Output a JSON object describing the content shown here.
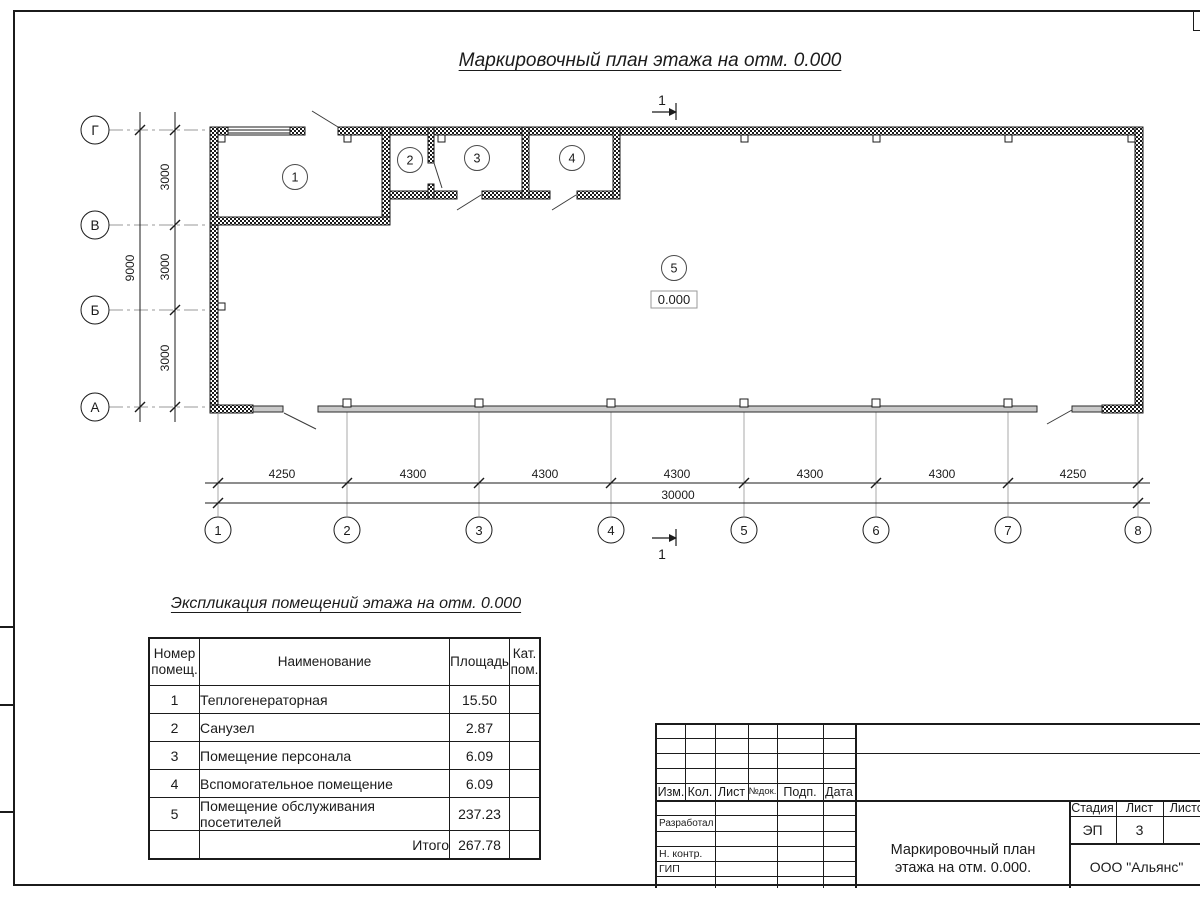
{
  "colors": {
    "ink": "#1b1b1b",
    "axis_gray": "#9a9a9a",
    "glazing_gray": "#c9c9c9"
  },
  "plan": {
    "title": "Маркировочный план этажа на отм. 0.000",
    "section_label": "1",
    "elevation": "0.000",
    "row_axes": [
      "Г",
      "В",
      "Б",
      "А"
    ],
    "col_axes": [
      "1",
      "2",
      "3",
      "4",
      "5",
      "6",
      "7",
      "8"
    ],
    "dims_vertical": [
      "3000",
      "3000",
      "3000"
    ],
    "dim_vertical_total": "9000",
    "dims_horizontal": [
      "4250",
      "4300",
      "4300",
      "4300",
      "4300",
      "4300",
      "4250"
    ],
    "dim_horizontal_total": "30000",
    "room_markers": [
      "1",
      "2",
      "3",
      "4",
      "5"
    ]
  },
  "schedule": {
    "title": "Экспликация помещений этажа на отм. 0.000",
    "headers": [
      "Номер\nпомещ.",
      "Наименование",
      "Площадь",
      "Кат.\nпом."
    ],
    "rows": [
      {
        "num": "1",
        "name": "Теплогенераторная",
        "area": "15.50",
        "cat": ""
      },
      {
        "num": "2",
        "name": "Санузел",
        "area": "2.87",
        "cat": ""
      },
      {
        "num": "3",
        "name": "Помещение персонала",
        "area": "6.09",
        "cat": ""
      },
      {
        "num": "4",
        "name": "Вспомогательное помещение",
        "area": "6.09",
        "cat": ""
      },
      {
        "num": "5",
        "name": "Помещение обслуживания посетителей",
        "area": "237.23",
        "cat": ""
      }
    ],
    "total_label": "Итого",
    "total_area": "267.78"
  },
  "stamp": {
    "rev_headers": [
      "Изм.",
      "Кол.",
      "Лист",
      "№док.",
      "Подп.",
      "Дата"
    ],
    "roles": [
      "Разработал",
      "Н. контр.",
      "ГИП"
    ],
    "stage_label": "Стадия",
    "sheet_label": "Лист",
    "sheets_label": "Листов",
    "stage_value": "ЭП",
    "sheet_value": "3",
    "doc_title": "Маркировочный план\nэтажа на отм. 0.000.",
    "company": "ООО \"Альянс\""
  }
}
